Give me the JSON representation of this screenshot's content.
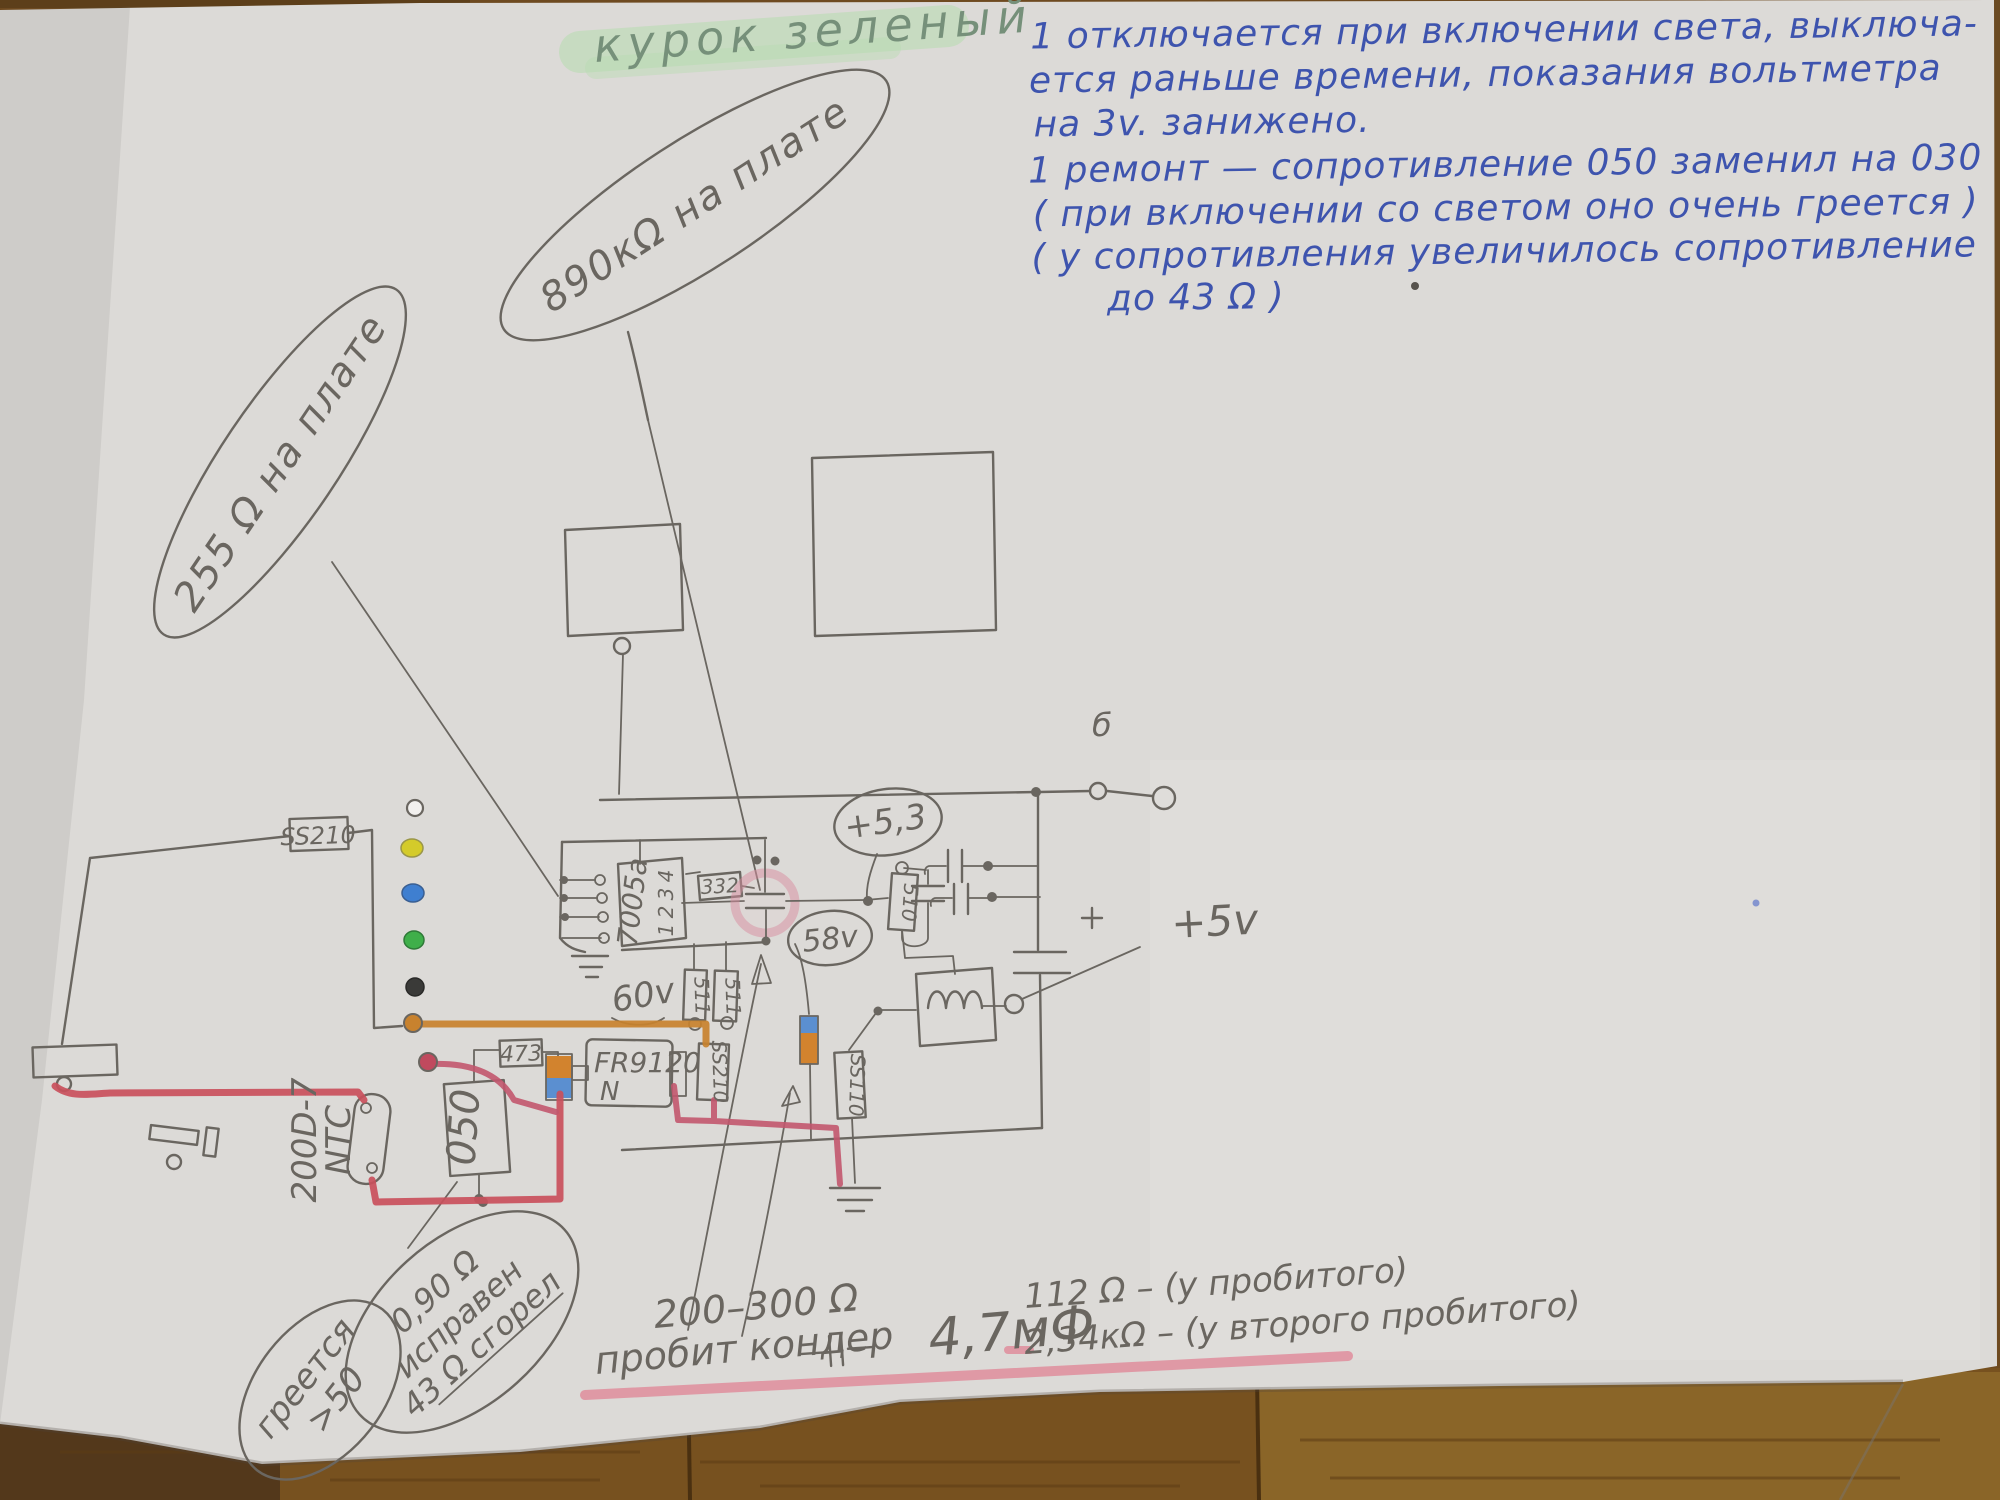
{
  "colors": {
    "blue_ink": "#3e54ae",
    "pencil": "#6a6660",
    "pencil_soft": "#8a8680",
    "highlight_green": "#b9dcb2",
    "title_green_text": "#76907a",
    "wire_red": "#c9505c",
    "wire_orange": "#c8822e",
    "wire_pink": "#c2566e",
    "underline_pink": "#e08898",
    "paper": "#dcdad7",
    "wood_dark": "#5d3f1a",
    "wood_mid": "#77511f",
    "wood_light": "#8a6528"
  },
  "title": {
    "text": "курок зеленый"
  },
  "top_note": {
    "lines": [
      "1 отключается при включении света, выключа-",
      "ется раньше времени, показания вольтметра",
      "на 3v. занижено.",
      "1 ремонт — сопротивление 050 заменил на 030",
      "( при включении со светом оно очень греется )",
      "( у сопротивления увеличилось сопротивление",
      "до 43 Ω )"
    ]
  },
  "callout_890": {
    "text": "890кΩ на плате"
  },
  "callout_255": {
    "text": "255 Ω на плате"
  },
  "heat_bubble": {
    "line1": "греется",
    "line2": ">50"
  },
  "resistor_bubble": {
    "line1": "0,90 Ω",
    "line2": "исправен",
    "line3": "43 Ω сгорел"
  },
  "bottom_note": {
    "range": "200–300 Ω",
    "broken": "пробит кондер",
    "cap_value": "4,7мФ",
    "r_first": "112 Ω – (у пробитого)",
    "r_second": "2,34кΩ – (у второго пробитого)"
  },
  "components": {
    "ss210_left": "SS210",
    "chip": "7005a",
    "pin4": "4",
    "pin3": "3",
    "pin2": "2",
    "pin1": "1",
    "r332": "332",
    "r511a": "511",
    "r511b": "511",
    "v60": "60v",
    "r473": "473",
    "mosfet": "FR9120",
    "mosfet_n": "N",
    "ss210_mid": "SS210",
    "ss110": "SS110",
    "r510": "510",
    "r050": "050",
    "ntc_line1": "200D-7",
    "ntc_line2": "NTC",
    "v53": "+5,3",
    "v58": "58v",
    "v5": "+5v",
    "point_b": "б"
  },
  "led_column": {
    "colors": [
      "#f2f0ee",
      "#d4cb2a",
      "#3f7fd0",
      "#3faf4a",
      "#3a3a38",
      "#c8822e",
      "#c04a5e"
    ]
  }
}
